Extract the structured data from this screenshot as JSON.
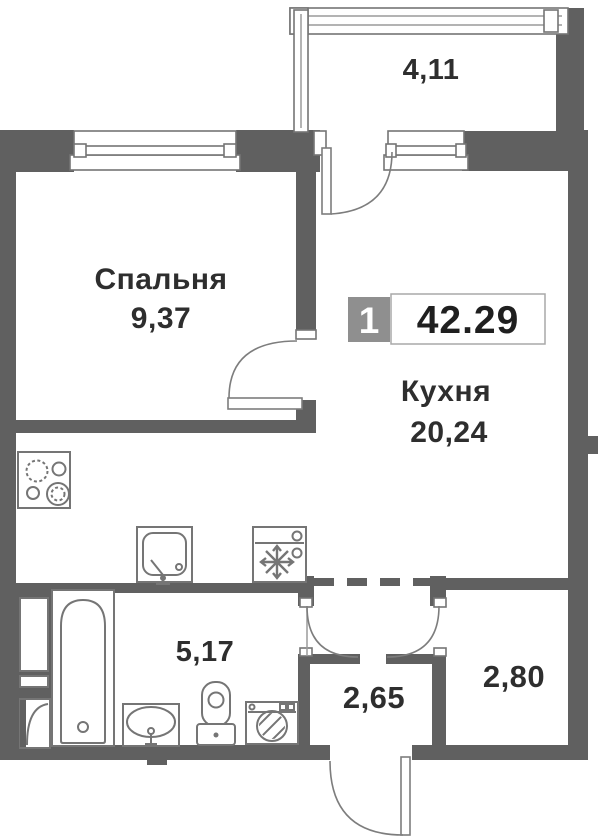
{
  "unit": {
    "rooms_count": "1",
    "total_area": "42.29"
  },
  "rooms": {
    "balcony": {
      "area": "4,11"
    },
    "bedroom": {
      "name": "Спальня",
      "area": "9,37"
    },
    "kitchen": {
      "name": "Кухня",
      "area": "20,24"
    },
    "bathroom": {
      "area": "5,17"
    },
    "hallway": {
      "area": "2,65"
    },
    "entry": {
      "area": "2,80"
    }
  },
  "fixtures": [
    "stove",
    "kitchen-sink",
    "fridge",
    "bathtub",
    "washbasin",
    "toilet",
    "washing-machine"
  ],
  "colors": {
    "wall": "#606060",
    "fixture_line": "#757575",
    "text": "#2e2e2e",
    "badge_bg": "#8f8f8f",
    "badge_text": "#ffffff",
    "area_box_border": "#a8a8a8",
    "background": "#ffffff"
  }
}
